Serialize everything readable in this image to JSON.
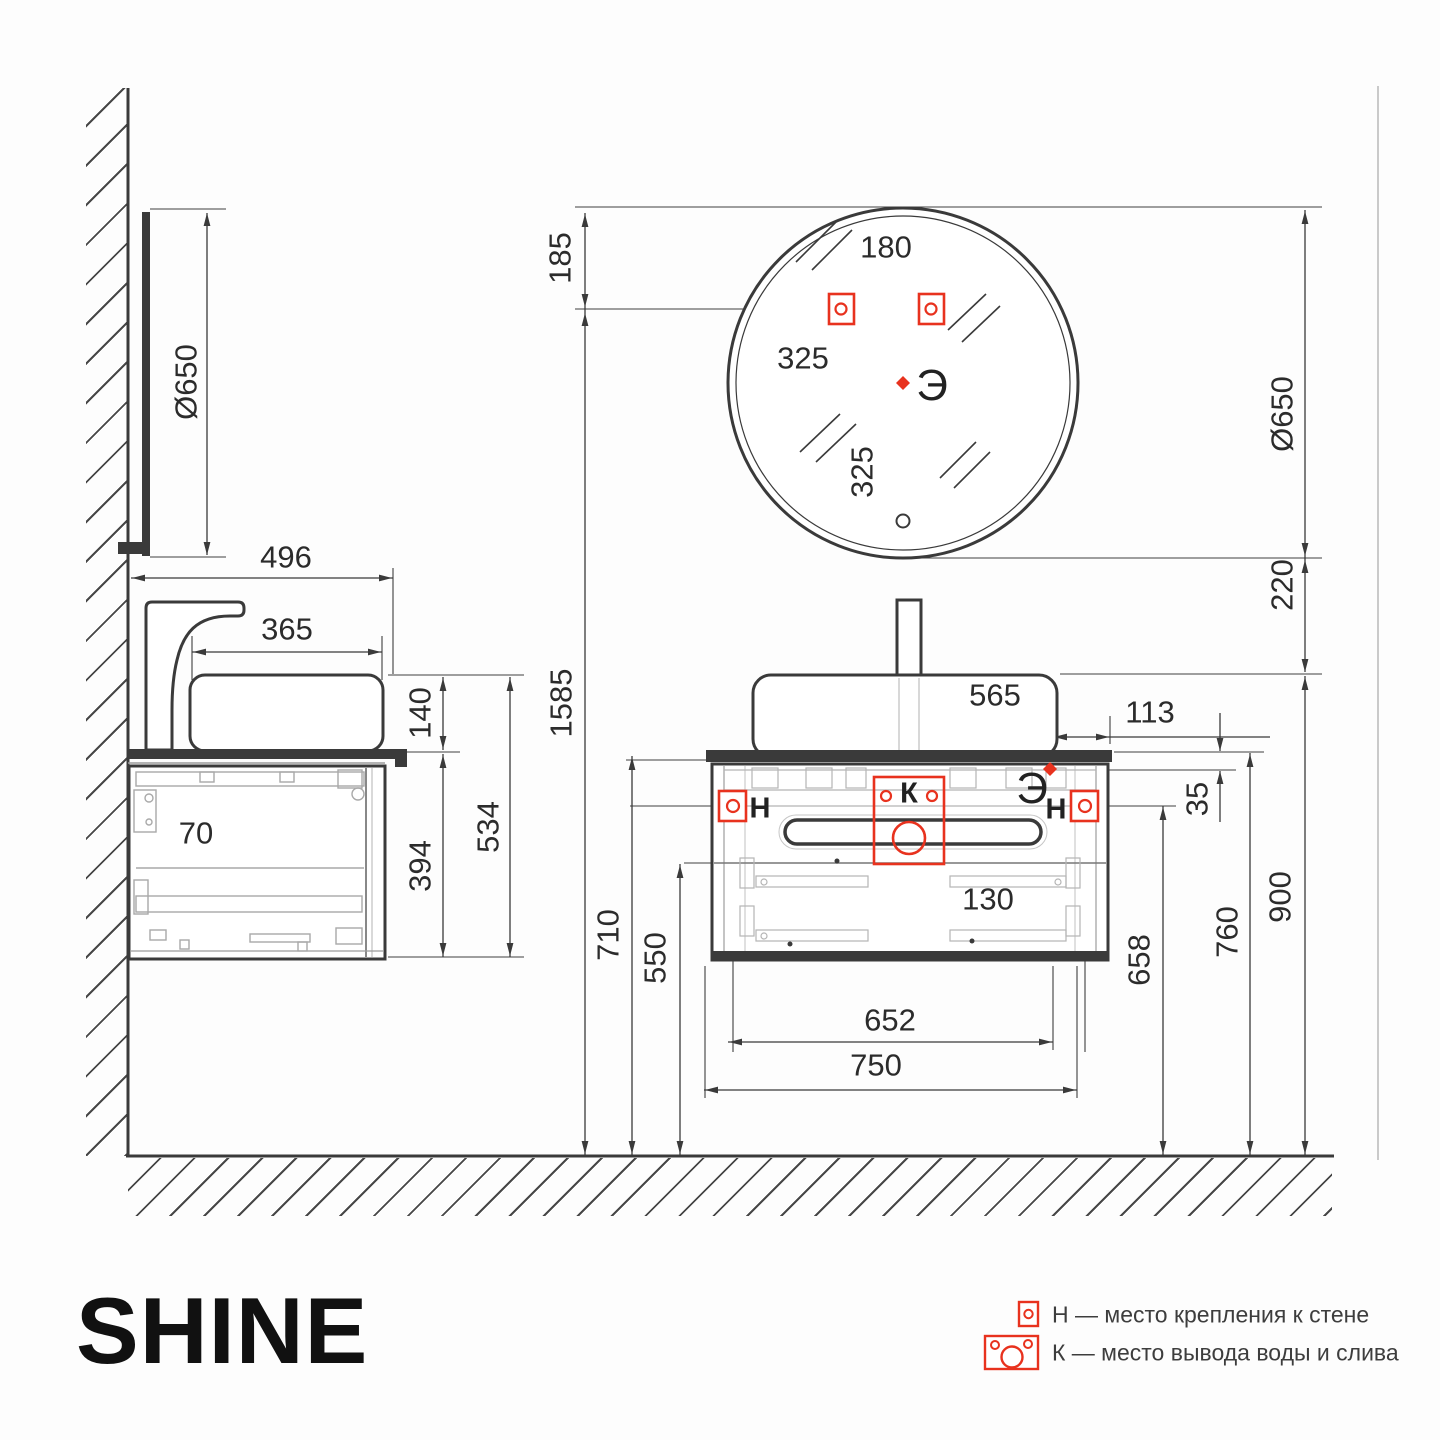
{
  "product": {
    "name": "SHINE"
  },
  "dims": {
    "mirror_diameter_side": "Ø650",
    "vanity_depth": "496",
    "sink_depth": "365",
    "sink_height": "140",
    "side_total_height": "534",
    "cabinet_height": "394",
    "wall_gap": "70",
    "mirror_top_gap": "185",
    "mirror_height_total": "1585",
    "mirror_hole_spacing": "180",
    "mirror_center_from_edge": "325",
    "mirror_center_to_bottom": "325",
    "mirror_diameter_front": "Ø650",
    "mirror_to_sink_gap": "220",
    "sink_width": "565",
    "sink_side_offset": "113",
    "outlet_below_top": "35",
    "drain_box_width": "130",
    "cabinet_top_height": "710",
    "drawer_split_height": "550",
    "mount_spacing": "652",
    "cabinet_width": "750",
    "mount_height": "658",
    "worktop_height": "760",
    "sink_rim_height": "900"
  },
  "markers": {
    "electric": "Э",
    "wall_mount": "Н",
    "water_drain": "К"
  },
  "legend": {
    "wall_mount_text": "Н — место крепления к стене",
    "drain_text": "К — место вывода воды и слива"
  },
  "colors": {
    "line": "#3a3a3a",
    "accent": "#e8321e",
    "hardware": "#a9a9a9"
  }
}
